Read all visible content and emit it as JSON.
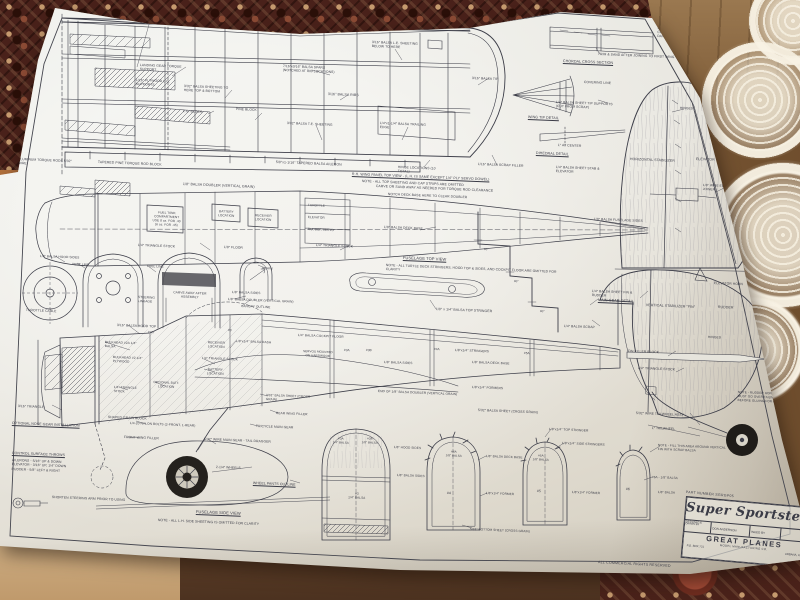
{
  "plan": {
    "title": "Super Sportster",
    "part_number": "PART NUMBER   SGRGP05",
    "designed_by_label": "DESIGNED &\nDRAWN BY",
    "designer": "DON ANDERSON",
    "inked_by_label": "INKED BY",
    "company": "GREAT  PLANES",
    "company_sub": "MODEL MANUFACTURING CO.",
    "address": "P.O. BOX 721",
    "city": "URBANA, IL",
    "rights": "ALL COMMERCIAL RIGHTS RESERVED"
  },
  "colors": {
    "ink": "#3d3e49",
    "paper": "#e9e7e0",
    "tablecloth": "#49211a",
    "wood": "#8d6b46",
    "doily": "#f3ead8",
    "tire": "#24211d"
  },
  "labels": [
    {
      "t": "1-3/4\" MAPLE WING BOLT DOWN PLATE (FILL ABOVE AND BELOW WITH BALSA)",
      "x": 112,
      "y": 12,
      "w": 170,
      "s": 3.5
    },
    {
      "t": "1/4\"x1/4\" BALSA LEADING EDGE",
      "x": 290,
      "y": 16,
      "w": 120,
      "s": 3.5
    },
    {
      "t": "3/16\" BALSA L.E. SHEETING BELOW TO HERE",
      "x": 372,
      "y": 40,
      "w": 52,
      "s": 3.3
    },
    {
      "t": "7/16\"x3/16\" BALSA SPARS (NOTCHED AT RIB LOCATIONS)",
      "x": 283,
      "y": 64,
      "w": 56,
      "s": 3.3
    },
    {
      "t": "3/16\" BALSA RIBS",
      "x": 328,
      "y": 92,
      "w": 60,
      "s": 3.5
    },
    {
      "t": "LANDING GEAR TORQUE SUPPORT",
      "x": 140,
      "y": 63,
      "w": 46,
      "s": 3.3
    },
    {
      "t": "1/16\" PLYWOOD L.G. SUPPORTS",
      "x": 136,
      "y": 78,
      "w": 44,
      "s": 3.3
    },
    {
      "t": "3/32\" BALSA SHEETING TO HERE TOP & BOTTOM",
      "x": 184,
      "y": 84,
      "w": 50,
      "s": 3.3
    },
    {
      "t": "L.G. BLOCK",
      "x": 183,
      "y": 109,
      "w": 40,
      "s": 3.3
    },
    {
      "t": "PINE BLOCK",
      "x": 236,
      "y": 107,
      "w": 26,
      "s": 3.3
    },
    {
      "t": "3/32\" BALSA T.E. SHEETING",
      "x": 287,
      "y": 121,
      "w": 46,
      "s": 3.3
    },
    {
      "t": "1/4\"x1-1/4\" BALSA TRAILING EDGE",
      "x": 380,
      "y": 121,
      "w": 50,
      "s": 3.3
    },
    {
      "t": "5/8\"x1-1/16\" TAPERED BALSA AILERON",
      "x": 276,
      "y": 160,
      "w": 135,
      "s": 3.4
    },
    {
      "t": "HINGE LOCATIONS (10 TOTAL)",
      "x": 398,
      "y": 165,
      "w": 48,
      "s": 3.3
    },
    {
      "t": "1/16\" BALSA SCRAP FILLER",
      "x": 478,
      "y": 162,
      "w": 46,
      "s": 3.3
    },
    {
      "t": "3/16\" BALSA TIP",
      "x": 472,
      "y": 76,
      "w": 34,
      "s": 3.3
    },
    {
      "t": "ALUMINUM TORQUE RODS 5/32\" WIRE",
      "x": 18,
      "y": 157,
      "w": 58,
      "s": 3.3
    },
    {
      "t": "TAPERED PINE TORQUE ROD BLOCK",
      "x": 98,
      "y": 160,
      "w": 118,
      "s": 3.4
    },
    {
      "t": "R.H. WING PANEL TOP VIEW - (L.H. IS SAME EXCEPT 1/4\" PLY SERVO DOWEL)",
      "x": 352,
      "y": 172,
      "w": 175,
      "s": 3.5,
      "u": 1
    },
    {
      "t": "NOTE - ALL TOP SHEETING AND CAP STRIPS ARE OMITTED",
      "x": 362,
      "y": 179,
      "w": 155,
      "s": 3.4
    },
    {
      "t": "1/8\" BALSA DOUBLER (VERTICAL GRAIN)",
      "x": 183,
      "y": 182,
      "w": 135,
      "s": 3.5
    },
    {
      "t": "TRIM & SAND AFTER JOINING TO FIRST WING",
      "x": 598,
      "y": 52,
      "w": 118,
      "s": 3.3
    },
    {
      "t": "CHORDAL CROSS SECTION",
      "x": 563,
      "y": 59,
      "w": 82,
      "s": 3.6,
      "u": 1
    },
    {
      "t": "COVERING LINE",
      "x": 584,
      "y": 80,
      "w": 45,
      "s": 3.3
    },
    {
      "t": "1/4\" BALSA SHEET TIP SUPPORTS (CUT FROM SCRAP)",
      "x": 556,
      "y": 100,
      "w": 64,
      "s": 3.3
    },
    {
      "t": "WING TIP DETAIL",
      "x": 528,
      "y": 115,
      "w": 60,
      "s": 3.6,
      "u": 1
    },
    {
      "t": "1° AT CENTER",
      "x": 558,
      "y": 143,
      "w": 40,
      "s": 3.3
    },
    {
      "t": "DIHEDRAL DETAIL",
      "x": 536,
      "y": 151,
      "w": 62,
      "s": 3.6,
      "u": 1
    },
    {
      "t": "1/4\" BALSA SHEET STAB & ELEVATOR",
      "x": 556,
      "y": 165,
      "w": 58,
      "s": 3.3
    },
    {
      "t": "NOTE - EPOXY CENTER SECTION JOINTS TOGETHER. FIBERGLASS TAPE APPLIED WITH RESIN MUST BE USED. FAILURE TO FOLLOW INSTRUCTIONS COVERING THIS STEP WILL RESULT IN A CRASH AND DAMAGED OTHERS.",
      "x": 658,
      "y": 17,
      "w": 92,
      "s": 3.3
    },
    {
      "t": "HINGES",
      "x": 680,
      "y": 106,
      "w": 30,
      "s": 3.3
    },
    {
      "t": "HORIZONTAL STABILIZER",
      "x": 630,
      "y": 157,
      "w": 56,
      "s": 3.5
    },
    {
      "t": "ELEVATOR",
      "x": 696,
      "y": 157,
      "w": 40,
      "s": 3.5
    },
    {
      "t": "1/8\" WIRE ELEVATOR JOINER",
      "x": 703,
      "y": 183,
      "w": 42,
      "s": 3.2
    },
    {
      "t": "ELEVATOR HORN",
      "x": 714,
      "y": 281,
      "w": 55,
      "s": 3.3
    },
    {
      "t": "1/4\" BALSA SHEET FIN & RUDDER",
      "x": 592,
      "y": 289,
      "w": 56,
      "s": 3.3
    },
    {
      "t": "1/4\" BALSA SCRAP",
      "x": 564,
      "y": 324,
      "w": 60,
      "s": 3.3
    },
    {
      "t": "VERTICAL STABILIZER \"FIN\"",
      "x": 646,
      "y": 303,
      "w": 62,
      "s": 3.5
    },
    {
      "t": "RUDDER",
      "x": 718,
      "y": 305,
      "w": 36,
      "s": 3.5
    },
    {
      "t": "HINGES",
      "x": 708,
      "y": 335,
      "w": 30,
      "s": 3.3
    },
    {
      "t": "FIN FILLER BLOCK",
      "x": 628,
      "y": 349,
      "w": 70,
      "s": 3.3
    },
    {
      "t": "1/4\" TRIANGLE STOCK",
      "x": 638,
      "y": 366,
      "w": 75,
      "s": 3.3
    },
    {
      "t": "NOTE - RUDDER HORN AND PLATE MUST GO OVER TAILWHEEL WIRE BEFORE GLUING FOR BALSA",
      "x": 738,
      "y": 390,
      "w": 60,
      "s": 3.1
    },
    {
      "t": "5/32\" WIRE TAILWHEEL ASSY",
      "x": 636,
      "y": 411,
      "w": 95,
      "s": 3.3
    },
    {
      "t": "1\" TAILWHEEL",
      "x": 652,
      "y": 426,
      "w": 45,
      "s": 3.3
    },
    {
      "t": "CARVE OR SAND AWAY AS NEEDED FOR TORQUE ROD CLEARANCE",
      "x": 376,
      "y": 184,
      "w": 168,
      "s": 3.4
    },
    {
      "t": "NOTCH DECK BASE HERE TO CLEAR DOUBLER",
      "x": 388,
      "y": 192,
      "w": 128,
      "s": 3.3
    },
    {
      "t": "THROTTLE",
      "x": 308,
      "y": 203,
      "w": 28,
      "s": 3.1
    },
    {
      "t": "ELEVATOR",
      "x": 308,
      "y": 215,
      "w": 28,
      "s": 3.1
    },
    {
      "t": "RUDDER SERVO",
      "x": 308,
      "y": 227,
      "w": 28,
      "s": 3.1
    },
    {
      "t": "FUEL TANK COMPARTMENT\nUSE 8 oz. FOR .40\n(6 oz. FOR .45)",
      "x": 149,
      "y": 210,
      "w": 36,
      "s": 3.1,
      "c": 1
    },
    {
      "t": "BATTERY LOCATION",
      "x": 214,
      "y": 209,
      "w": 25,
      "s": 3.1,
      "c": 1
    },
    {
      "t": "RECEIVER LOCATION",
      "x": 250,
      "y": 213,
      "w": 27,
      "s": 3.1,
      "c": 1
    },
    {
      "t": "1/8\" BALSA DECK BASE",
      "x": 384,
      "y": 225,
      "w": 60,
      "s": 3.3
    },
    {
      "t": "1/8\" BALSA FUSELAGE SIDES",
      "x": 594,
      "y": 217,
      "w": 62,
      "s": 3.3
    },
    {
      "t": "1/4\" TRIANGLE STOCK",
      "x": 138,
      "y": 243,
      "w": 62,
      "s": 3.3
    },
    {
      "t": "1/4\" TRIANGLE STOCK",
      "x": 316,
      "y": 243,
      "w": 62,
      "s": 3.3
    },
    {
      "t": "1/8\" FLOOR",
      "x": 224,
      "y": 245,
      "w": 30,
      "s": 3.3
    },
    {
      "t": "FUSELAGE TOP VIEW",
      "x": 403,
      "y": 255,
      "w": 92,
      "s": 4,
      "u": 1
    },
    {
      "t": "NOTE - ALL TURTLE DECK STRINGERS, HOOD TOP & SIDES, AND COCKPIT FLOOR ARE OMITTED FOR CLARITY",
      "x": 386,
      "y": 263,
      "w": 172,
      "s": 3.3
    },
    {
      "t": "MAIN GEAR DETAIL",
      "x": 598,
      "y": 298,
      "w": 70,
      "s": 3.7,
      "u": 1
    },
    {
      "t": "1/8\" x 1/4\" BALSA TOP STRINGER",
      "x": 436,
      "y": 307,
      "w": 108,
      "s": 3.4
    },
    {
      "t": "1/8\" BALSA HOOD SIDES",
      "x": 40,
      "y": 254,
      "w": 48,
      "s": 3.2
    },
    {
      "t": "VENT LINE",
      "x": 72,
      "y": 262,
      "w": 30,
      "s": 3.2
    },
    {
      "t": "FUEL LINE",
      "x": 147,
      "y": 264,
      "w": 24,
      "s": 3.2
    },
    {
      "t": "3/16\" BALSA HOOD TOP",
      "x": 117,
      "y": 323,
      "w": 88,
      "s": 3.3
    },
    {
      "t": "CARVE AWAY AFTER ASSEMBLY",
      "x": 167,
      "y": 290,
      "w": 46,
      "s": 3.2,
      "c": 1
    },
    {
      "t": "GRAIN",
      "x": 262,
      "y": 266,
      "w": 24,
      "s": 3.2
    },
    {
      "t": "STEERING LINKAGE",
      "x": 138,
      "y": 295,
      "w": 32,
      "s": 3.2
    },
    {
      "t": "THROTTLE CABLE",
      "x": 26,
      "y": 308,
      "w": 48,
      "s": 3.3
    },
    {
      "t": "1/8\" BALSA SIDES",
      "x": 232,
      "y": 290,
      "w": 48,
      "s": 3.2
    },
    {
      "t": "1/8\" BALSA DOUBLER (VERTICAL GRAIN)",
      "x": 228,
      "y": 297,
      "w": 82,
      "s": 3.2
    },
    {
      "t": "CANOPY OUTLINE",
      "x": 241,
      "y": 304,
      "w": 55,
      "s": 3.2
    },
    {
      "t": "90°",
      "x": 484,
      "y": 248,
      "w": 14,
      "s": 3
    },
    {
      "t": "90°",
      "x": 514,
      "y": 280,
      "w": 14,
      "s": 3
    },
    {
      "t": "90°",
      "x": 540,
      "y": 310,
      "w": 14,
      "s": 3
    },
    {
      "t": "BULKHEAD #2A 1/4\" BALSA",
      "x": 105,
      "y": 340,
      "w": 42,
      "s": 3.2
    },
    {
      "t": "BULKHEAD #2 1/4\" PLYWOOD",
      "x": 113,
      "y": 355,
      "w": 42,
      "s": 3.2
    },
    {
      "t": "RECEIVER LOCATION",
      "x": 202,
      "y": 340,
      "w": 29,
      "s": 3.2,
      "c": 1
    },
    {
      "t": "1/8\"x1/4\" BALSA DASH",
      "x": 236,
      "y": 339,
      "w": 38,
      "s": 3.2
    },
    {
      "t": "1/4\" TRIANGLE STOCK",
      "x": 202,
      "y": 356,
      "w": 65,
      "s": 3.2
    },
    {
      "t": "BATTERY LOCATION",
      "x": 202,
      "y": 367,
      "w": 27,
      "s": 3.2,
      "c": 1
    },
    {
      "t": "OPTIONAL BATT. LOCATION",
      "x": 152,
      "y": 380,
      "w": 29,
      "s": 3.1,
      "c": 1
    },
    {
      "t": "1/4\" TRIANGLE STOCK",
      "x": 114,
      "y": 385,
      "w": 31,
      "s": 3.1
    },
    {
      "t": "3/16\" TRIANGLE",
      "x": 18,
      "y": 404,
      "w": 58,
      "s": 3.3
    },
    {
      "t": "SHAPED GRAIN BLOCK",
      "x": 108,
      "y": 415,
      "w": 94,
      "s": 3.3
    },
    {
      "t": "1/4-20 NYLON BOLTS (2-FRONT, 1-REAR)",
      "x": 130,
      "y": 421,
      "w": 78,
      "s": 3.2
    },
    {
      "t": "FRONT WING FILLER",
      "x": 124,
      "y": 435,
      "w": 84,
      "s": 3.3
    },
    {
      "t": "REAR WING FILLER",
      "x": 276,
      "y": 411,
      "w": 56,
      "s": 3.2
    },
    {
      "t": "3/32\" BALSA SHEET (CROSS GRAIN)",
      "x": 266,
      "y": 393,
      "w": 50,
      "s": 3.1
    },
    {
      "t": "TRICYCLE MAIN GEAR",
      "x": 256,
      "y": 424,
      "w": 80,
      "s": 3.3
    },
    {
      "t": "5/32\" WIRE MAIN GEAR - TAIL DRAGGER",
      "x": 204,
      "y": 437,
      "w": 118,
      "s": 3.3
    },
    {
      "t": "2-1/4\" WHEELS",
      "x": 216,
      "y": 465,
      "w": 60,
      "s": 3.3
    },
    {
      "t": "WHEEL PANTS OUTLINE",
      "x": 253,
      "y": 481,
      "w": 90,
      "s": 3.5,
      "u": 1
    },
    {
      "t": "1/4\" BALSA COCKPIT FLOOR",
      "x": 298,
      "y": 333,
      "w": 66,
      "s": 3.2
    },
    {
      "t": "SERVOS MOUNTED ON HARDWOOD",
      "x": 303,
      "y": 350,
      "w": 30,
      "s": 3,
      "c": 1
    },
    {
      "t": "1/8\" BALSA SIDES",
      "x": 384,
      "y": 360,
      "w": 52,
      "s": 3.2
    },
    {
      "t": "1/8\"x1/4\" STRINGERS",
      "x": 455,
      "y": 348,
      "w": 58,
      "s": 3.2
    },
    {
      "t": "1/8\" BALSA DECK BASE",
      "x": 472,
      "y": 360,
      "w": 64,
      "s": 3.2
    },
    {
      "t": "END OF 1/8\" BALSA DOUBLER (VERTICAL GRAIN)",
      "x": 378,
      "y": 389,
      "w": 90,
      "s": 3.2
    },
    {
      "t": "1/8\"x1/4\" FORMERS",
      "x": 472,
      "y": 385,
      "w": 62,
      "s": 3.2
    },
    {
      "t": "5/32\" BALSA SHEET (CROSS GRAIN)",
      "x": 478,
      "y": 408,
      "w": 108,
      "s": 3.3
    },
    {
      "t": "#2A",
      "x": 148,
      "y": 330,
      "w": 14,
      "s": 3.1
    },
    {
      "t": "#3",
      "x": 228,
      "y": 328,
      "w": 12,
      "s": 3.1
    },
    {
      "t": "#3A",
      "x": 344,
      "y": 348,
      "w": 14,
      "s": 3.1
    },
    {
      "t": "#3B",
      "x": 366,
      "y": 348,
      "w": 14,
      "s": 3.1
    },
    {
      "t": "#4A",
      "x": 434,
      "y": 347,
      "w": 14,
      "s": 3.1
    },
    {
      "t": "#5A",
      "x": 524,
      "y": 351,
      "w": 14,
      "s": 3.1
    },
    {
      "t": "#3A\n1/4\" BALSA",
      "x": 328,
      "y": 437,
      "w": 26,
      "s": 2.9,
      "c": 1
    },
    {
      "t": "#3B\n1/8\" BALSA",
      "x": 357,
      "y": 437,
      "w": 26,
      "s": 2.9,
      "c": 1
    },
    {
      "t": "1/8\" HOOD SIDES",
      "x": 394,
      "y": 445,
      "w": 30,
      "s": 3.1
    },
    {
      "t": "#3\n1/4\" BALSA",
      "x": 342,
      "y": 491,
      "w": 30,
      "s": 3.1,
      "c": 1
    },
    {
      "t": "1/8\" BALSA SIDES",
      "x": 397,
      "y": 473,
      "w": 32,
      "s": 3.1
    },
    {
      "t": "#4A\n1/8\" BALSA",
      "x": 440,
      "y": 450,
      "w": 28,
      "s": 2.9,
      "c": 1
    },
    {
      "t": "1/8\" BALSA DECK BASE",
      "x": 486,
      "y": 454,
      "w": 40,
      "s": 3.1
    },
    {
      "t": "#4",
      "x": 447,
      "y": 491,
      "w": 14,
      "s": 3.5
    },
    {
      "t": "1/8\"x1/4\" FORMER",
      "x": 486,
      "y": 491,
      "w": 44,
      "s": 3.1
    },
    {
      "t": "5/32\" BOTTOM SHEET (CROSS GRAIN)",
      "x": 470,
      "y": 527,
      "w": 62,
      "s": 3.1
    },
    {
      "t": "1/8\"x1/4\" TOP STRINGER",
      "x": 549,
      "y": 427,
      "w": 102,
      "s": 3.2
    },
    {
      "t": "1/8\"x1/4\" SIDE STRINGERS",
      "x": 562,
      "y": 441,
      "w": 108,
      "s": 3.2
    },
    {
      "t": "#5A\n1/8\" BALSA",
      "x": 528,
      "y": 454,
      "w": 26,
      "s": 2.9,
      "c": 1
    },
    {
      "t": "#5",
      "x": 537,
      "y": 489,
      "w": 14,
      "s": 3.5
    },
    {
      "t": "1/8\"x1/4\" FORMER",
      "x": 572,
      "y": 490,
      "w": 44,
      "s": 3.1
    },
    {
      "t": "NOTE - FILL THIS AREA AROUND VERTICAL FIN WITH SCRAP BALSA",
      "x": 658,
      "y": 443,
      "w": 72,
      "s": 3.1
    },
    {
      "t": "#6A - 1/8\" BALSA",
      "x": 652,
      "y": 475,
      "w": 48,
      "s": 3.1
    },
    {
      "t": "1/8\" BALSA",
      "x": 658,
      "y": 490,
      "w": 34,
      "s": 3.1
    },
    {
      "t": "#6",
      "x": 626,
      "y": 487,
      "w": 12,
      "s": 3.5
    },
    {
      "t": "OPTIONAL NOSE GEAR INSTALLATION",
      "x": 12,
      "y": 421,
      "w": 124,
      "s": 3.5,
      "u": 1
    },
    {
      "t": "CONTROL SURFACE THROWS",
      "x": 12,
      "y": 451,
      "w": 92,
      "s": 3.5,
      "u": 1
    },
    {
      "t": "AILERONS - 5/16\" UP & DOWN\nELEVATOR - 3/16\" UP, 1/4\" DOWN\nRUDDER  - 5/8\" LEFT & RIGHT",
      "x": 12,
      "y": 458,
      "w": 102,
      "s": 3.3
    },
    {
      "t": "SHORTEN STEERING ARM PRIOR TO USING",
      "x": 52,
      "y": 495,
      "w": 88,
      "s": 3.3
    },
    {
      "t": "FUSELAGE SIDE VIEW",
      "x": 196,
      "y": 509,
      "w": 94,
      "s": 4,
      "u": 1
    },
    {
      "t": "NOTE - ALL L.H. SIDE SHEETING IS OMITTED FOR CLARITY",
      "x": 158,
      "y": 518,
      "w": 178,
      "s": 3.4
    }
  ]
}
